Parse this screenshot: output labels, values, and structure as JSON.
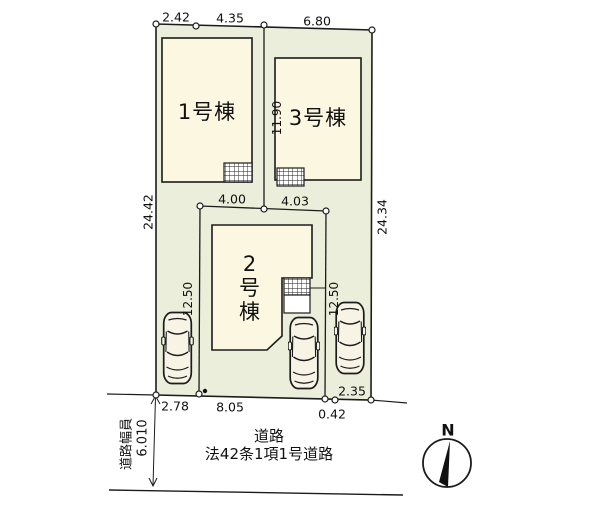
{
  "plan": {
    "buildings": {
      "b1_label": "1号棟",
      "b2_chars": [
        "2",
        "号",
        "棟"
      ],
      "b3_label": "3号棟"
    },
    "dimensions": {
      "top_left": "2.42",
      "top_mid": "4.35",
      "top_right": "6.80",
      "left_side": "24.42",
      "right_side": "24.34",
      "center_vertical": "11.90",
      "lot2_top_left": "4.00",
      "lot2_top_right": "4.03",
      "lot2_left_side": "12.50",
      "lot2_right_side": "12.50",
      "bottom_1": "2.78",
      "bottom_2": "8.05",
      "bottom_3": "0.42",
      "bottom_4": "2.35"
    },
    "road": {
      "name": "道路",
      "classification": "法42条1項1号道路",
      "width_label": "道路幅員",
      "width_value": "6.010"
    },
    "compass": {
      "north": "N"
    },
    "colors": {
      "site_fill": "#eaeeda",
      "building_fill": "#fcf7e0",
      "car_fill": "#f7f4e6",
      "line": "#1c1c1c"
    }
  }
}
